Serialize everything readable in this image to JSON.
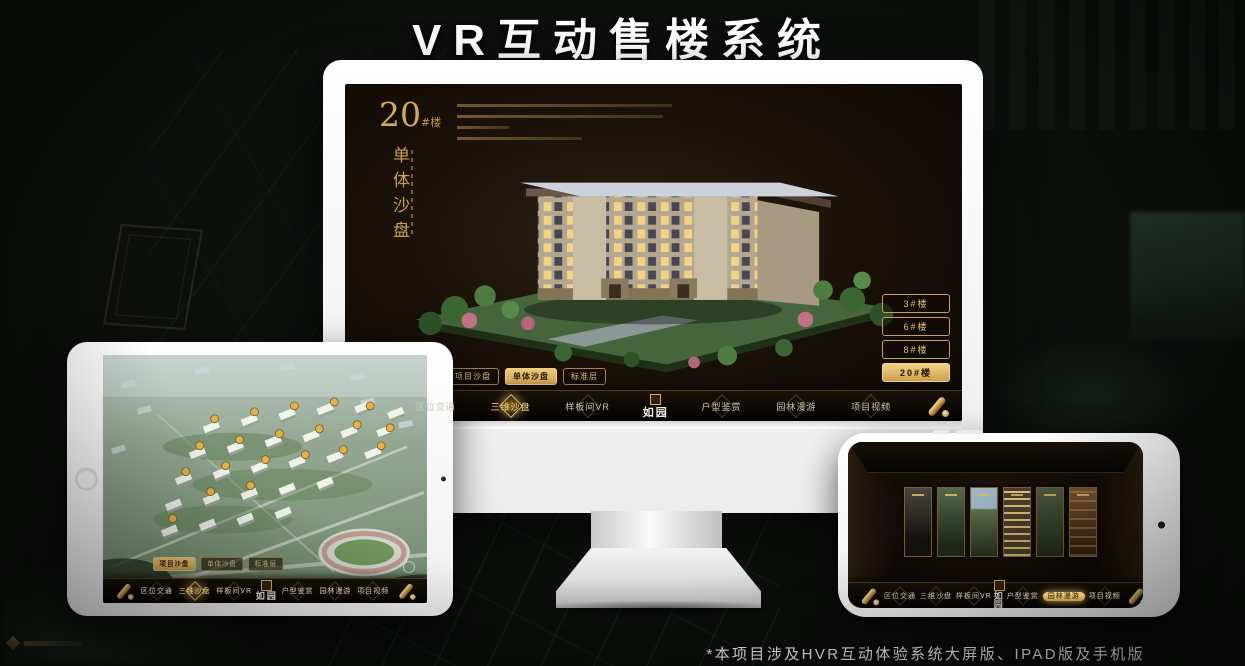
{
  "page": {
    "title": "VR互动售楼系统",
    "footnote": "*本项目涉及HVR互动体验系统大屏版、IPAD版及手机版"
  },
  "colors": {
    "gold": "#d2a855",
    "gold_selected_bg": "#e8c87c",
    "screen_dark": "#171006",
    "bezel_white": "#ffffff"
  },
  "icons": {
    "nav_end": "scroll-icon",
    "brand_seal": "seal-icon",
    "tablet_home": "home-button",
    "camera": "camera-dot",
    "compass": "compass-icon"
  },
  "monitor": {
    "panel": {
      "number": "20",
      "number_suffix": "#楼",
      "subtitle": "单体沙盘"
    },
    "floor_buttons": [
      "3#楼",
      "6#楼",
      "8#楼",
      "20#楼"
    ],
    "selected_floor": "20#楼",
    "mode_tabs": [
      "项目沙盘",
      "单体沙盘",
      "标准层"
    ],
    "selected_mode": "单体沙盘",
    "nav": {
      "items": [
        "区位交通",
        "三维沙盘",
        "样板间VR",
        "户型鉴赏",
        "园林漫游",
        "项目视频"
      ],
      "selected": "三维沙盘",
      "logo": "如园"
    }
  },
  "tablet": {
    "mode_tabs": [
      "项目沙盘",
      "单体沙盘",
      "标准层"
    ],
    "selected_mode": "项目沙盘",
    "nav": {
      "items": [
        "区位交通",
        "三维沙盘",
        "样板间VR",
        "户型鉴赏",
        "园林漫游",
        "项目视频"
      ],
      "selected": "三维沙盘",
      "logo": "如园"
    }
  },
  "phone": {
    "nav": {
      "items": [
        "区位交通",
        "三维沙盘",
        "样板间VR",
        "户型鉴赏",
        "园林漫游",
        "项目视频"
      ],
      "selected": "园林漫游",
      "logo": "如园"
    }
  }
}
